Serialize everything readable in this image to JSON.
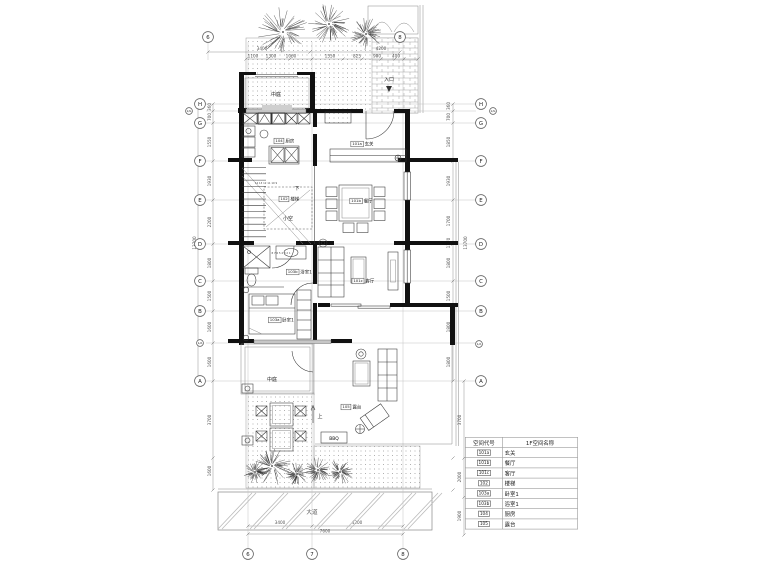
{
  "colors": {
    "wall": "#111111",
    "line": "#333333",
    "dim_text": "#555555",
    "site_line": "#888888",
    "paper": "#ffffff"
  },
  "grid": {
    "left": [
      "H",
      "1/G",
      "G",
      "F",
      "E",
      "D",
      "C",
      "B",
      "1/A",
      "A"
    ],
    "right": [
      "H",
      "1/G",
      "G",
      "F",
      "E",
      "D",
      "C",
      "B",
      "1/A",
      "A"
    ],
    "top": [
      "6",
      "8"
    ],
    "bottom": [
      "6",
      "7",
      "8"
    ]
  },
  "dimensions": {
    "top_totals": [
      "3400",
      "4200"
    ],
    "top_segments": [
      "1100",
      "1300",
      "1060",
      "1550",
      "825",
      "900",
      "400"
    ],
    "left_segments": [
      "360",
      "700",
      "1550",
      "1930",
      "2200",
      "1800",
      "1500",
      "1600",
      "1600",
      "3700",
      "1600"
    ],
    "left_total": "13700",
    "right_segments": [
      "360",
      "700",
      "1850",
      "1930",
      "1700",
      "1370",
      "1800",
      "1500",
      "1800",
      "1800",
      "3700",
      "2000",
      "1900"
    ],
    "right_total": "13700",
    "bottom_segments": [
      "3400",
      "4200"
    ],
    "bottom_total": "7600"
  },
  "rooms": {
    "entry": {
      "code": "101a",
      "name": "玄关"
    },
    "dining": {
      "code": "101b",
      "name": "餐厅"
    },
    "living": {
      "code": "101c",
      "name": "客厅"
    },
    "stair": {
      "code": "102",
      "name": "楼梯"
    },
    "bedroom": {
      "code": "103a",
      "name": "卧室1"
    },
    "bath": {
      "code": "103b",
      "name": "浴室1"
    },
    "kitchen": {
      "code": "104",
      "name": "厨房"
    },
    "terrace": {
      "code": "105",
      "name": "露台"
    }
  },
  "labels": {
    "courtyard_top": "中庭",
    "courtyard_bottom": "中庭",
    "entrance": "入口",
    "bbq": "BBQ",
    "road": "大道",
    "void": "小空",
    "stair_down": "下",
    "stair_up": "上",
    "stair_numbers_upper": "14 13 12 11 10 9",
    "stair_numbers_lower": "8 7 6 5 4 3 2 1"
  },
  "legend": {
    "headers": [
      "空间代号",
      "1F空间名称"
    ],
    "rows": [
      [
        "101a",
        "玄关"
      ],
      [
        "101b",
        "餐厅"
      ],
      [
        "101c",
        "客厅"
      ],
      [
        "102",
        "楼梯"
      ],
      [
        "103a",
        "卧室1"
      ],
      [
        "103b",
        "浴室1"
      ],
      [
        "104",
        "厨房"
      ],
      [
        "105",
        "露台"
      ]
    ]
  }
}
